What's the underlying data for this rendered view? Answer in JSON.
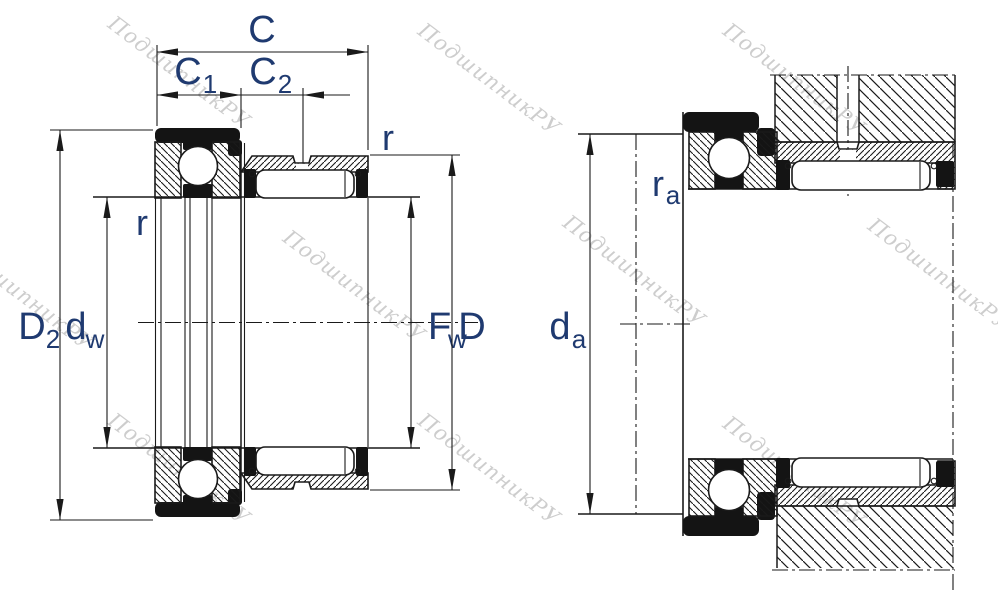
{
  "drawing": {
    "type": "bearing-cross-section-technical-drawing",
    "views": {
      "left": "bearing dimensions",
      "right": "mounting / abutment dimensions"
    }
  },
  "labels": {
    "c": "C",
    "c1": {
      "base": "C",
      "sub": "1"
    },
    "c2": {
      "base": "C",
      "sub": "2"
    },
    "r_outer": "r",
    "r_inner": "r",
    "d2": {
      "base": "D",
      "sub": "2"
    },
    "dw": {
      "base": "d",
      "sub": "w"
    },
    "fw": {
      "base": "F",
      "sub": "w"
    },
    "d": "D",
    "da": {
      "base": "d",
      "sub": "a"
    },
    "ra": {
      "base": "r",
      "sub": "a"
    }
  },
  "watermark": {
    "text": "ПодшипникРУ"
  },
  "colors": {
    "line": "#1a1a1a",
    "label": "#1f3a70",
    "watermark": "#c5c5c5",
    "seal": "#141414",
    "paper": "#ffffff"
  }
}
